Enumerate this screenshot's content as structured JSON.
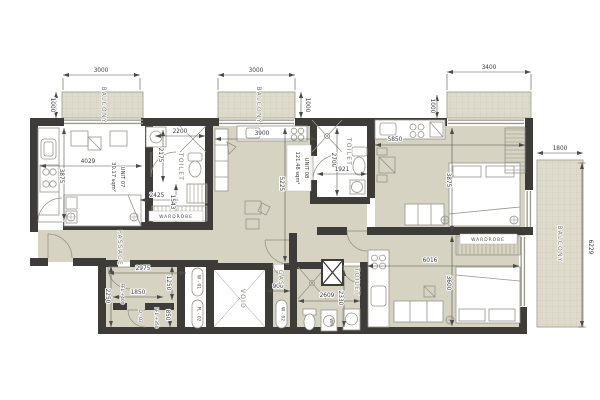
{
  "units": {
    "u07": {
      "name": "UNIT 07",
      "area": "30.17 sqm²"
    },
    "u08": {
      "name": "UNIT 08",
      "area": "121.48 sqm²"
    }
  },
  "labels": {
    "balcony_left": "BALCONY",
    "balcony_mid": "BALCONY",
    "balcony_side": "BALCONY",
    "toilet_u07": "TOILET",
    "toilet_u08": "TOILET",
    "toilet_lower": "TOILET",
    "passage": "PASSAGE",
    "void": "VOID",
    "gas": "GAS",
    "wardrobe_u07": "WARDROBE",
    "wardrobe_bedroom": "WARDROBE",
    "washing_machine": "WM",
    "ffl_400": "FFL +400",
    "ffl_350": "FFL +350"
  },
  "tags": {
    "w01": "W - 01",
    "fl02": "FL - 02",
    "w02": "W - 02",
    "d03": "D - 03"
  },
  "dims": {
    "top_3000_left": "3000",
    "top_3000_mid": "3000",
    "top_3400": "3400",
    "v1000_left": "1000",
    "v1000_mid": "1000",
    "v1000_right": "1000",
    "right_1800": "1800",
    "right_6229": "6229",
    "u07_3875": "3875",
    "u07_4029": "4029",
    "u07_2200": "2200",
    "u07_2175": "2175",
    "u07_1543": "1543",
    "u07_2425": "2425",
    "u08_3900": "3900",
    "u08_5225": "5225",
    "u08_2700": "2700",
    "u08_1921": "1921",
    "rt_5850": "5850",
    "rt_3875": "3875",
    "rb_6016": "6016",
    "rb_3600": "3600",
    "lt_2609": "2609",
    "lt_2330": "2330",
    "gas_900": "900",
    "ll_2975": "2975",
    "ll_1250": "1250",
    "ll_1850": "1850",
    "ll_2250": "2250",
    "ll_850": "850"
  },
  "colors": {
    "wall": "#3e3c38",
    "floor": "#d6d3c3",
    "balcony": "#dedbcc",
    "line": "#96948a"
  }
}
